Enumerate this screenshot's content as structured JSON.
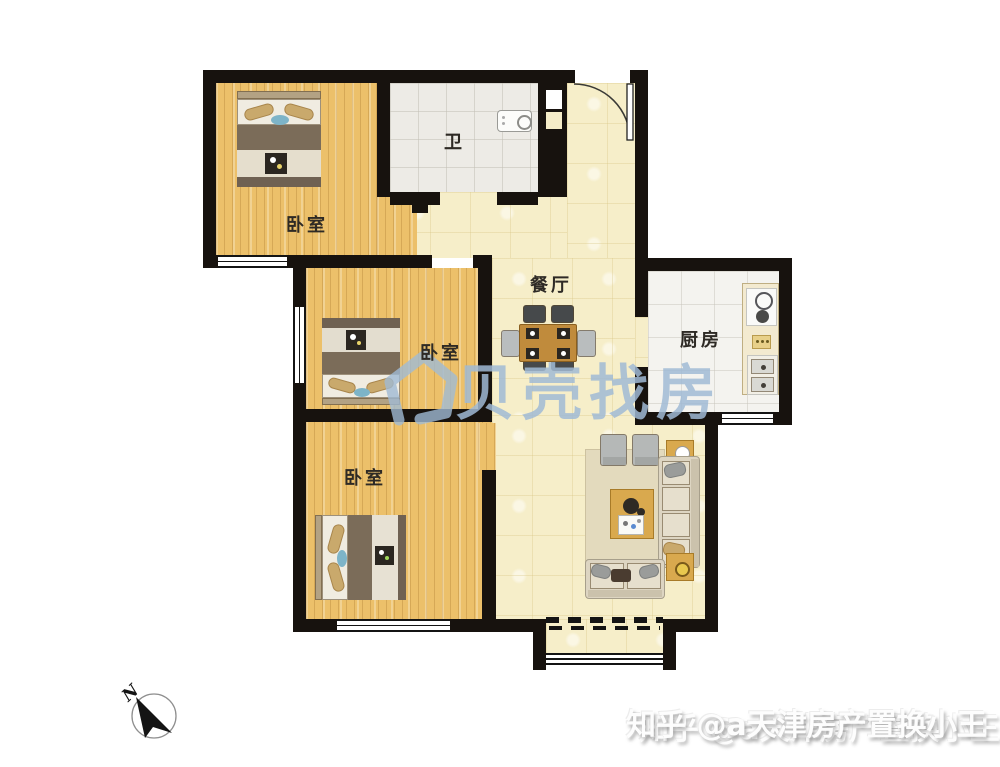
{
  "plan": {
    "rooms": {
      "bedroom_top": {
        "label": "卧室"
      },
      "bedroom_middle": {
        "label": "卧室"
      },
      "bedroom_bottom": {
        "label": "卧室"
      },
      "bathroom": {
        "label": "卫"
      },
      "dining": {
        "label": "餐厅"
      },
      "kitchen": {
        "label": "厨房"
      }
    },
    "compass": {
      "north_label": "N"
    }
  },
  "watermarks": {
    "beike": {
      "brand_text": "贝壳找房"
    },
    "zhihu": {
      "text": "知乎 @a天津房产置换小王"
    }
  },
  "colors": {
    "wall": "#17120e",
    "wood_floor": "#ecc06a",
    "hall_floor": "#f6eec9",
    "bath_tile": "#edebe6",
    "kitchen_tile": "#f4f3ef",
    "watermark_blue": "#a0bad5"
  }
}
